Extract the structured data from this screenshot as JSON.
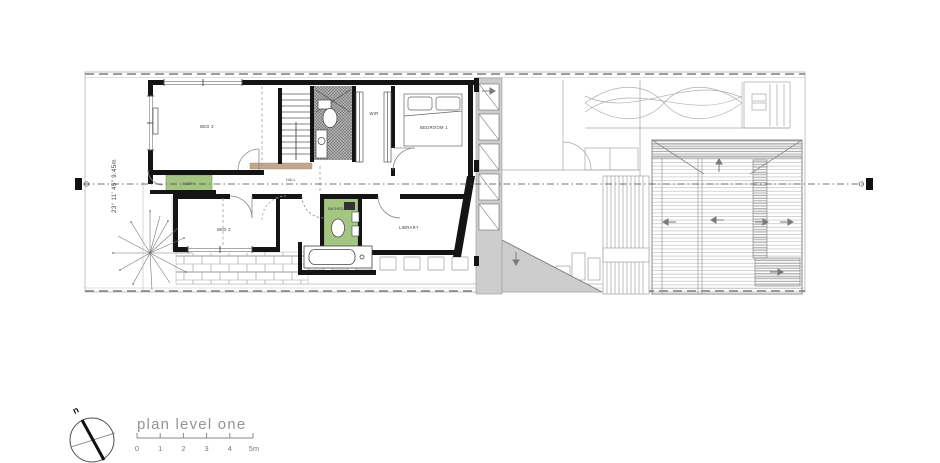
{
  "title_block": {
    "plan_label": "plan level one",
    "scale_ticks": [
      "0",
      "1",
      "2",
      "3",
      "4",
      "5m"
    ],
    "north_label": "n"
  },
  "site": {
    "left_boundary_dimension": "23° 11' 45\"   9.45m"
  },
  "rooms": {
    "bed3": "BED 3",
    "entry": "ENTRY",
    "hall": "HALL",
    "wir": "WIR",
    "bedroom1": "BEDROOM 1",
    "bed2": "BED 2",
    "bathroom": "BATHROOM",
    "library": "LIBRARY"
  },
  "colors": {
    "wall": "#141414",
    "wet_area_green": "#a5c583",
    "screen_gray": "#cdcdcd",
    "ghost_line": "#9a9a9a",
    "label_text": "#333333",
    "title_text": "#949494"
  }
}
